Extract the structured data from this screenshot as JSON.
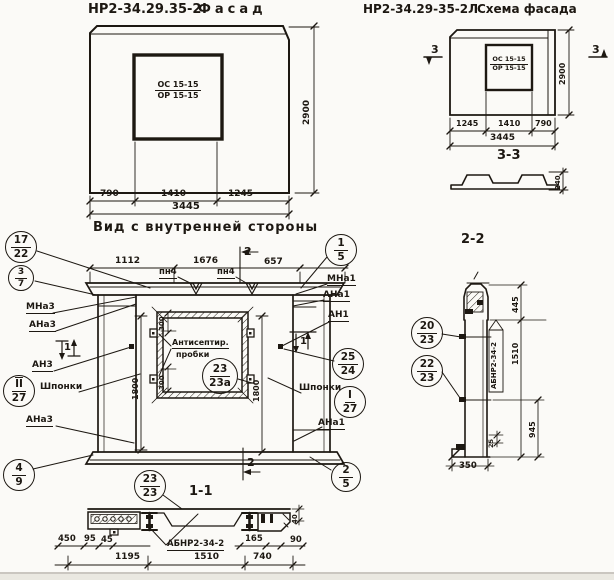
{
  "drawing": {
    "left": {
      "code": "НР2-34.29.35-2",
      "name": "Фасад",
      "mark_top": "ОС 15-15",
      "mark_bot": "ОР 15-15",
      "d1": "790",
      "d2": "1410",
      "d3": "1245",
      "total": "3445",
      "h": "2900"
    },
    "right": {
      "code": "НР2-34.29-35-2Л",
      "name": "Схема фасада",
      "mark_top": "ОС 15-15",
      "mark_bot": "ОР 15-15",
      "d1": "1245",
      "d2": "1410",
      "d3": "790",
      "total": "3445",
      "h": "2900",
      "marker": "3",
      "sec": "3-3",
      "depth": "240"
    },
    "inner": {
      "title": "Вид с внутренней стороны",
      "d1": "1112",
      "d2": "1676",
      "d3": "657",
      "pn4": "пн4",
      "m2": "2",
      "m1": "1",
      "d300": "300",
      "d1800": "1800",
      "note1": "Антисептир.",
      "note2": "пробки",
      "shponki": "Шпонки",
      "mna3": "МНа3",
      "ana3": "АНа3",
      "an3": "АН3",
      "ana3b": "АНа3",
      "mna1": "МНа1",
      "ana1": "АНа1",
      "an1": "АН1",
      "ana1b": "АНа1",
      "sec11": "1-1"
    },
    "s11": {
      "label": "АБНР2-34-2",
      "d450": "450",
      "d95": "95",
      "d45": "45",
      "d165": "165",
      "d90": "90",
      "d40": "40",
      "d1195": "1195",
      "d1510": "1510",
      "d740": "740"
    },
    "s22": {
      "title": "2-2",
      "label": "АБНР2-34-2",
      "d445": "445",
      "d1510": "1510",
      "d945": "945",
      "d25": "25",
      "d350": "350"
    },
    "callouts": {
      "c17_22": {
        "top": "17",
        "bot": "22"
      },
      "c3_7": {
        "top": "3",
        "bot": "7"
      },
      "c1_5": {
        "top": "1",
        "bot": "5"
      },
      "cII_27": {
        "top": "II",
        "bot": "27"
      },
      "c25_24": {
        "top": "25",
        "bot": "24"
      },
      "cI_27": {
        "top": "I",
        "bot": "27"
      },
      "c4_9": {
        "top": "4",
        "bot": "9"
      },
      "c2_5": {
        "top": "2",
        "bot": "5"
      },
      "c23_23": {
        "top": "23",
        "bot": "23"
      },
      "c23_23a": {
        "top": "23",
        "bot": "23а"
      },
      "c20_23": {
        "top": "20",
        "bot": "23"
      },
      "c22_23": {
        "top": "22",
        "bot": "23"
      }
    }
  }
}
